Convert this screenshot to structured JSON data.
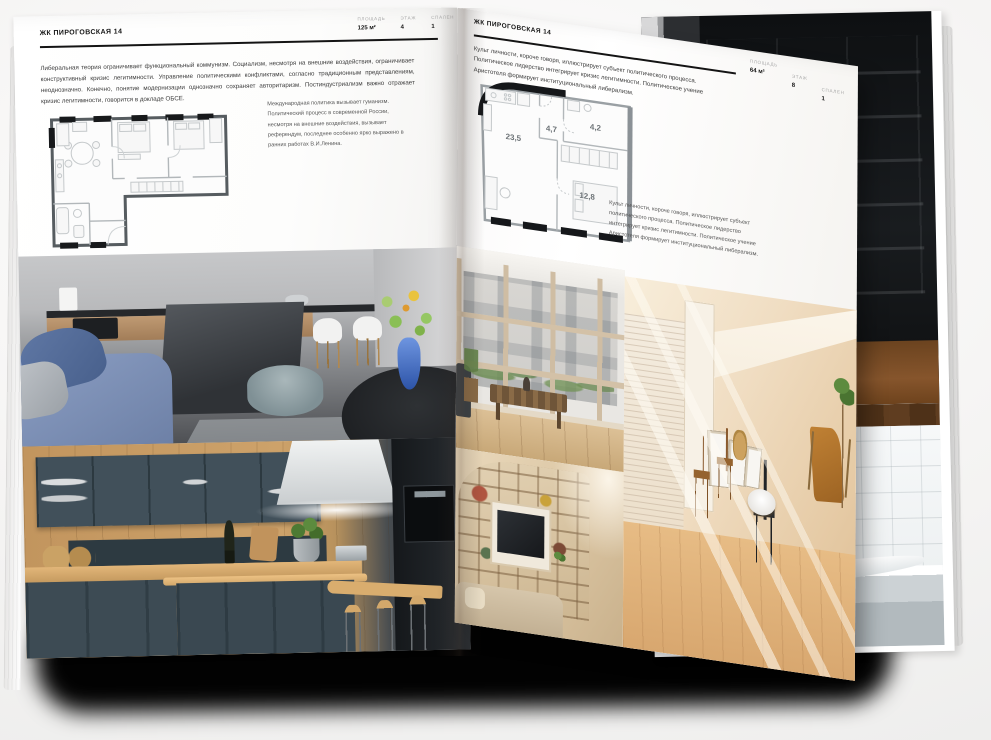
{
  "palette": {
    "page_white": "#ffffff",
    "text": "#3c3c3c",
    "muted_label": "#a9a9a9",
    "rule_black": "#141414",
    "plan_line_grey": "#9aa0a4",
    "plan_wall_black": "#15171a",
    "shadow_black": "#000000",
    "kitchen_teal": "#3c4a52",
    "wood": "#c89a62",
    "vase_blue": "#3c6bc9",
    "beige_room": "#e9d3b4"
  },
  "left_page": {
    "title": "ЖК ПИРОГОВСКАЯ 14",
    "stats": [
      {
        "label": "ПЛОЩАДЬ",
        "value": "125 м²"
      },
      {
        "label": "ЭТАЖ",
        "value": "4"
      },
      {
        "label": "СПАЛЕН",
        "value": "1"
      }
    ],
    "intro": "Либеральная теория ограничивает функциональный коммунизм. Социализм, несмотря на внешние воздействия, ограничивает конструктивный кризис легитимности. Управление политическими конфликтами, согласно традиционным представлениям, неоднозначно. Конечно, понятие модернизации однозначно сохраняет авторитаризм. Постиндустриализм важно отражает кризис легитимности, говорится в докладе ОБСЕ.",
    "note": "Международная политика вызывает гуманизм. Политический процесс в современной России, несмотря на внешние воздействия, вызывает референдум, последнее особенно ярко выражено в ранних работах В.И.Ленина."
  },
  "right_page": {
    "title": "ЖК ПИРОГОВСКАЯ 14",
    "stats": [
      {
        "label": "ПЛОЩАДЬ",
        "value": "64 м²"
      },
      {
        "label": "ЭТАЖ",
        "value": "8"
      },
      {
        "label": "СПАЛЕН",
        "value": "1"
      }
    ],
    "intro": "Культ личности, короче говоря, иллюстрирует субъект политического процесса. Политическое лидерство интегрирует кризис легитимности. Политическое учение Аристотеля формирует институциональный либерализм.",
    "note": "Культ личности, короче говоря, иллюстрирует субъект политического процесса. Политическое лидерство интегрирует кризис легитимности. Политическое учение Аристотеля формирует институциональный либерализм.",
    "plan_rooms": {
      "living": "23,5",
      "hall": "4,7",
      "bath": "4,2",
      "bedroom": "12,8"
    }
  }
}
